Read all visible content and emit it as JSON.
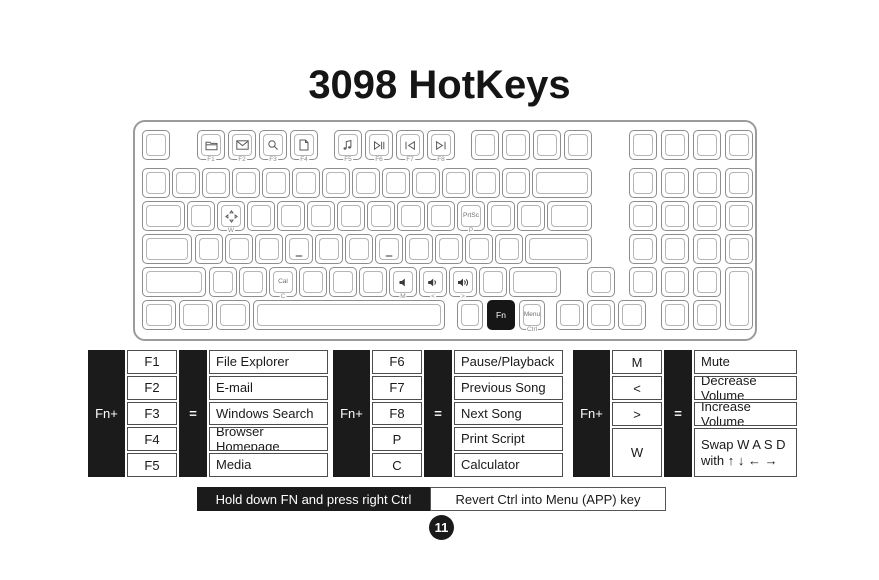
{
  "title": "3098 HotKeys",
  "page_number": "11",
  "footer": {
    "left_label": "Hold down FN and press right Ctrl",
    "right_label": "Revert Ctrl into Menu (APP) key"
  },
  "colors": {
    "ink": "#1a1a1a",
    "table_black": "#1b1b1b",
    "cell_border": "#4d4d4d",
    "key_border": "#8d8d8d",
    "icon_gray": "#5a5a5a"
  },
  "tables": [
    {
      "fn_label": "Fn+",
      "eq_label": "=",
      "rows": [
        {
          "key": "F1",
          "desc": "File Explorer"
        },
        {
          "key": "F2",
          "desc": "E-mail"
        },
        {
          "key": "F3",
          "desc": "Windows Search"
        },
        {
          "key": "F4",
          "desc": "Browser Homepage"
        },
        {
          "key": "F5",
          "desc": "Media"
        }
      ]
    },
    {
      "fn_label": "Fn+",
      "eq_label": "=",
      "rows": [
        {
          "key": "F6",
          "desc": "Pause/Playback"
        },
        {
          "key": "F7",
          "desc": "Previous Song"
        },
        {
          "key": "F8",
          "desc": "Next Song"
        },
        {
          "key": "P",
          "desc": "Print Script"
        },
        {
          "key": "C",
          "desc": "Calculator"
        }
      ]
    },
    {
      "fn_label": "Fn+",
      "eq_label": "=",
      "rows": [
        {
          "key": "M",
          "desc": "Mute"
        },
        {
          "key": "<",
          "desc": "Decrease Volume"
        },
        {
          "key": ">",
          "desc": "Increase Volume"
        },
        {
          "key": "W",
          "desc": "Swap W A S D\nwith  ↑ ↓ ← →",
          "tall": true
        }
      ]
    }
  ],
  "keyboard": {
    "rows_y": [
      8,
      46,
      79,
      112,
      145,
      178
    ],
    "key_height": 30,
    "keys": [
      {
        "id": "esc",
        "r": 0,
        "x": 7,
        "w": 28
      },
      {
        "id": "f1",
        "r": 0,
        "x": 62,
        "w": 28,
        "icon": "file-explorer",
        "sub": "F1"
      },
      {
        "id": "f2",
        "r": 0,
        "x": 93,
        "w": 28,
        "icon": "mail",
        "sub": "F2"
      },
      {
        "id": "f3",
        "r": 0,
        "x": 124,
        "w": 28,
        "icon": "search",
        "sub": "F3"
      },
      {
        "id": "f4",
        "r": 0,
        "x": 155,
        "w": 28,
        "icon": "homepage",
        "sub": "F4"
      },
      {
        "id": "f5",
        "r": 0,
        "x": 199,
        "w": 28,
        "icon": "media",
        "sub": "F5"
      },
      {
        "id": "f6",
        "r": 0,
        "x": 230,
        "w": 28,
        "icon": "play-pause",
        "sub": "F6"
      },
      {
        "id": "f7",
        "r": 0,
        "x": 261,
        "w": 28,
        "icon": "prev-track",
        "sub": "F7"
      },
      {
        "id": "f8",
        "r": 0,
        "x": 292,
        "w": 28,
        "icon": "next-track",
        "sub": "F8"
      },
      {
        "id": "f9",
        "r": 0,
        "x": 336,
        "w": 28
      },
      {
        "id": "f10",
        "r": 0,
        "x": 367,
        "w": 28
      },
      {
        "id": "f11",
        "r": 0,
        "x": 398,
        "w": 28
      },
      {
        "id": "f12",
        "r": 0,
        "x": 429,
        "w": 28
      },
      {
        "id": "np-a1",
        "r": 0,
        "x": 494,
        "w": 28
      },
      {
        "id": "np-a2",
        "r": 0,
        "x": 526,
        "w": 28
      },
      {
        "id": "np-a3",
        "r": 0,
        "x": 558,
        "w": 28
      },
      {
        "id": "np-a4",
        "r": 0,
        "x": 590,
        "w": 28
      },
      {
        "id": "grave",
        "r": 1,
        "x": 7,
        "w": 28
      },
      {
        "id": "n1",
        "r": 1,
        "x": 37,
        "w": 28
      },
      {
        "id": "n2",
        "r": 1,
        "x": 67,
        "w": 28
      },
      {
        "id": "n3",
        "r": 1,
        "x": 97,
        "w": 28
      },
      {
        "id": "n4",
        "r": 1,
        "x": 127,
        "w": 28
      },
      {
        "id": "n5",
        "r": 1,
        "x": 157,
        "w": 28
      },
      {
        "id": "n6",
        "r": 1,
        "x": 187,
        "w": 28
      },
      {
        "id": "n7",
        "r": 1,
        "x": 217,
        "w": 28
      },
      {
        "id": "n8",
        "r": 1,
        "x": 247,
        "w": 28
      },
      {
        "id": "n9",
        "r": 1,
        "x": 277,
        "w": 28
      },
      {
        "id": "n0",
        "r": 1,
        "x": 307,
        "w": 28
      },
      {
        "id": "minus",
        "r": 1,
        "x": 337,
        "w": 28
      },
      {
        "id": "equal",
        "r": 1,
        "x": 367,
        "w": 28
      },
      {
        "id": "backspace",
        "r": 1,
        "x": 397,
        "w": 60
      },
      {
        "id": "np-b1",
        "r": 1,
        "x": 494,
        "w": 28
      },
      {
        "id": "np-b2",
        "r": 1,
        "x": 526,
        "w": 28
      },
      {
        "id": "np-b3",
        "r": 1,
        "x": 558,
        "w": 28
      },
      {
        "id": "np-b4",
        "r": 1,
        "x": 590,
        "w": 28
      },
      {
        "id": "tab",
        "r": 2,
        "x": 7,
        "w": 43
      },
      {
        "id": "q",
        "r": 2,
        "x": 52,
        "w": 28
      },
      {
        "id": "w",
        "r": 2,
        "x": 82,
        "w": 28,
        "icon": "move-arrows",
        "sub": "W"
      },
      {
        "id": "e",
        "r": 2,
        "x": 112,
        "w": 28
      },
      {
        "id": "rk",
        "r": 2,
        "x": 142,
        "w": 28
      },
      {
        "id": "tk",
        "r": 2,
        "x": 172,
        "w": 28
      },
      {
        "id": "yk",
        "r": 2,
        "x": 202,
        "w": 28
      },
      {
        "id": "uk",
        "r": 2,
        "x": 232,
        "w": 28
      },
      {
        "id": "ik",
        "r": 2,
        "x": 262,
        "w": 28
      },
      {
        "id": "ok",
        "r": 2,
        "x": 292,
        "w": 28
      },
      {
        "id": "p",
        "r": 2,
        "x": 322,
        "w": 28,
        "label": "PrtSc",
        "sub": "P"
      },
      {
        "id": "lbracket",
        "r": 2,
        "x": 352,
        "w": 28
      },
      {
        "id": "rbracket",
        "r": 2,
        "x": 382,
        "w": 28
      },
      {
        "id": "backslash",
        "r": 2,
        "x": 412,
        "w": 45
      },
      {
        "id": "np-c1",
        "r": 2,
        "x": 494,
        "w": 28
      },
      {
        "id": "np-c2",
        "r": 2,
        "x": 526,
        "w": 28
      },
      {
        "id": "np-c3",
        "r": 2,
        "x": 558,
        "w": 28
      },
      {
        "id": "np-c4",
        "r": 2,
        "x": 590,
        "w": 28
      },
      {
        "id": "caps",
        "r": 3,
        "x": 7,
        "w": 50
      },
      {
        "id": "a",
        "r": 3,
        "x": 60,
        "w": 28
      },
      {
        "id": "s",
        "r": 3,
        "x": 90,
        "w": 28
      },
      {
        "id": "d",
        "r": 3,
        "x": 120,
        "w": 28
      },
      {
        "id": "f",
        "r": 3,
        "x": 150,
        "w": 28,
        "homing": true
      },
      {
        "id": "g",
        "r": 3,
        "x": 180,
        "w": 28
      },
      {
        "id": "h",
        "r": 3,
        "x": 210,
        "w": 28
      },
      {
        "id": "j",
        "r": 3,
        "x": 240,
        "w": 28,
        "homing": true
      },
      {
        "id": "k",
        "r": 3,
        "x": 270,
        "w": 28
      },
      {
        "id": "l",
        "r": 3,
        "x": 300,
        "w": 28
      },
      {
        "id": "semicolon",
        "r": 3,
        "x": 330,
        "w": 28
      },
      {
        "id": "quote",
        "r": 3,
        "x": 360,
        "w": 28
      },
      {
        "id": "enter",
        "r": 3,
        "x": 390,
        "w": 67
      },
      {
        "id": "np-d1",
        "r": 3,
        "x": 494,
        "w": 28
      },
      {
        "id": "np-d2",
        "r": 3,
        "x": 526,
        "w": 28
      },
      {
        "id": "np-d3",
        "r": 3,
        "x": 558,
        "w": 28
      },
      {
        "id": "np-d4",
        "r": 3,
        "x": 590,
        "w": 28
      },
      {
        "id": "lshift",
        "r": 4,
        "x": 7,
        "w": 64
      },
      {
        "id": "z",
        "r": 4,
        "x": 74,
        "w": 28
      },
      {
        "id": "x",
        "r": 4,
        "x": 104,
        "w": 28
      },
      {
        "id": "c",
        "r": 4,
        "x": 134,
        "w": 28,
        "label": "Cal",
        "sub": "C"
      },
      {
        "id": "v",
        "r": 4,
        "x": 164,
        "w": 28
      },
      {
        "id": "b",
        "r": 4,
        "x": 194,
        "w": 28
      },
      {
        "id": "n",
        "r": 4,
        "x": 224,
        "w": 28
      },
      {
        "id": "m",
        "r": 4,
        "x": 254,
        "w": 28,
        "icon": "mute",
        "sub": "M"
      },
      {
        "id": "comma",
        "r": 4,
        "x": 284,
        "w": 28,
        "icon": "volume-down",
        "sub": "<"
      },
      {
        "id": "period",
        "r": 4,
        "x": 314,
        "w": 28,
        "icon": "volume-up",
        "sub": ">"
      },
      {
        "id": "slash",
        "r": 4,
        "x": 344,
        "w": 28
      },
      {
        "id": "rshift",
        "r": 4,
        "x": 374,
        "w": 52
      },
      {
        "id": "arrow-up",
        "r": 4,
        "x": 452,
        "w": 28
      },
      {
        "id": "np-1",
        "r": 4,
        "x": 494,
        "w": 28
      },
      {
        "id": "np-2",
        "r": 4,
        "x": 526,
        "w": 28
      },
      {
        "id": "np-3",
        "r": 4,
        "x": 558,
        "w": 28
      },
      {
        "id": "np-enter",
        "r": 4,
        "x": 590,
        "w": 28,
        "h": 63
      },
      {
        "id": "lctrl",
        "r": 5,
        "x": 7,
        "w": 34
      },
      {
        "id": "win",
        "r": 5,
        "x": 44,
        "w": 34
      },
      {
        "id": "lalt",
        "r": 5,
        "x": 81,
        "w": 34
      },
      {
        "id": "space",
        "r": 5,
        "x": 118,
        "w": 192
      },
      {
        "id": "ralt",
        "r": 5,
        "x": 322,
        "w": 26
      },
      {
        "id": "fn",
        "r": 5,
        "x": 352,
        "w": 28,
        "label": "Fn",
        "style": "black"
      },
      {
        "id": "menu",
        "r": 5,
        "x": 384,
        "w": 26,
        "label": "Menu",
        "sub": "Ctrl"
      },
      {
        "id": "arrow-left",
        "r": 5,
        "x": 421,
        "w": 28
      },
      {
        "id": "arrow-down",
        "r": 5,
        "x": 452,
        "w": 28
      },
      {
        "id": "arrow-right",
        "r": 5,
        "x": 483,
        "w": 28
      },
      {
        "id": "np-0",
        "r": 5,
        "x": 526,
        "w": 28
      },
      {
        "id": "np-dot",
        "r": 5,
        "x": 558,
        "w": 28
      }
    ]
  }
}
